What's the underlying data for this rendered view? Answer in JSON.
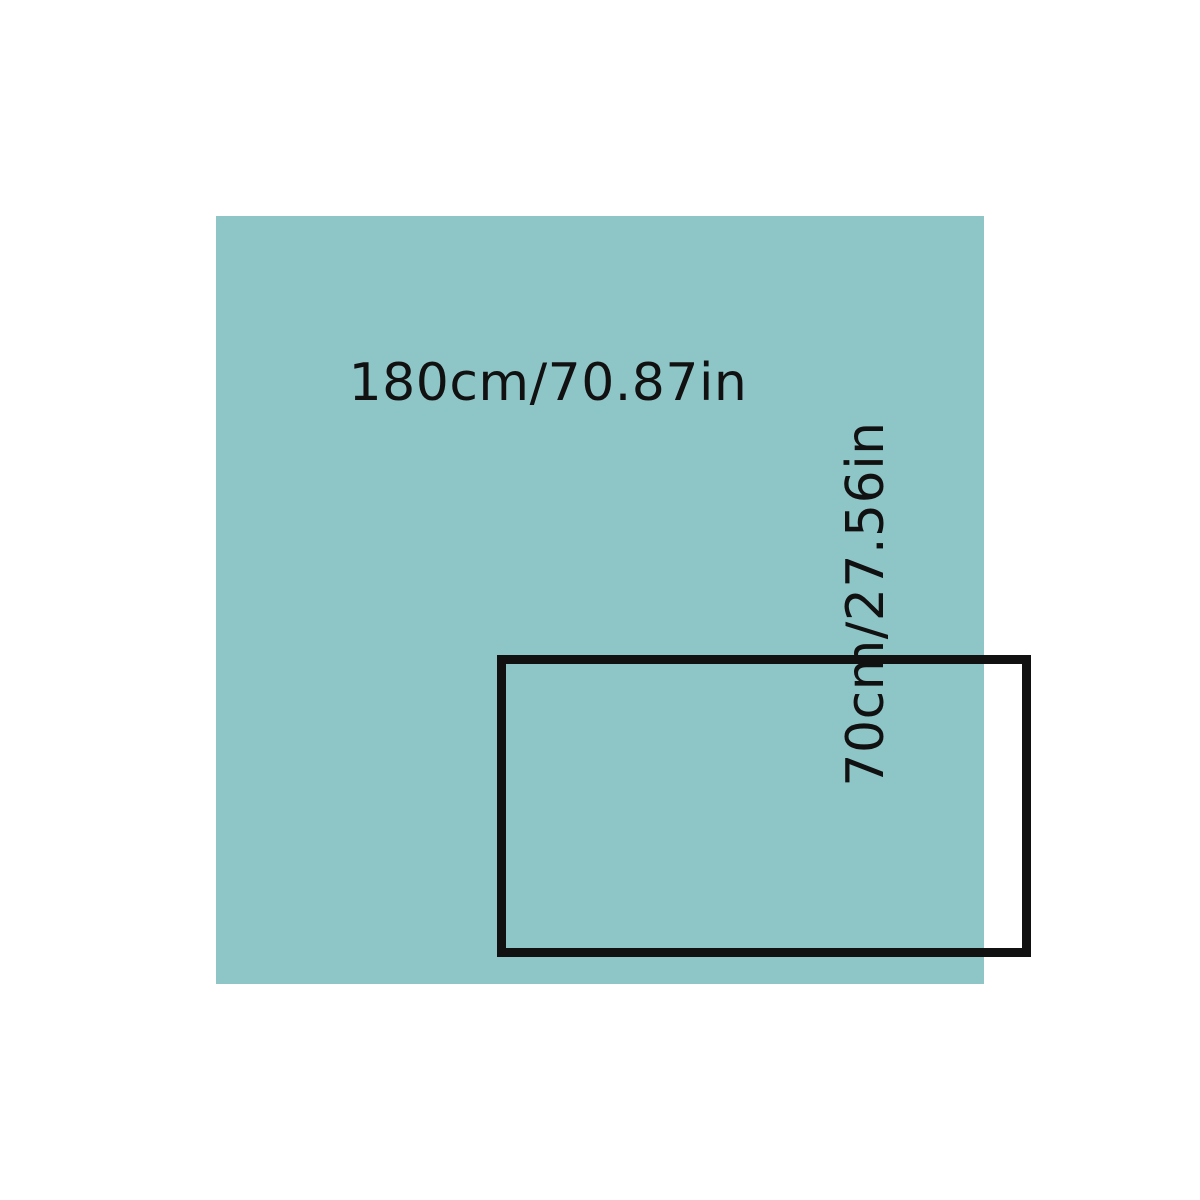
{
  "diagram": {
    "type": "product-dimension-diagram",
    "width_label": "180cm/70.87in",
    "height_label": "70cm/27.56in",
    "colors": {
      "background": "#ffffff",
      "panel": "#8ec6c8",
      "outline": "#111111",
      "text": "#111111"
    }
  }
}
